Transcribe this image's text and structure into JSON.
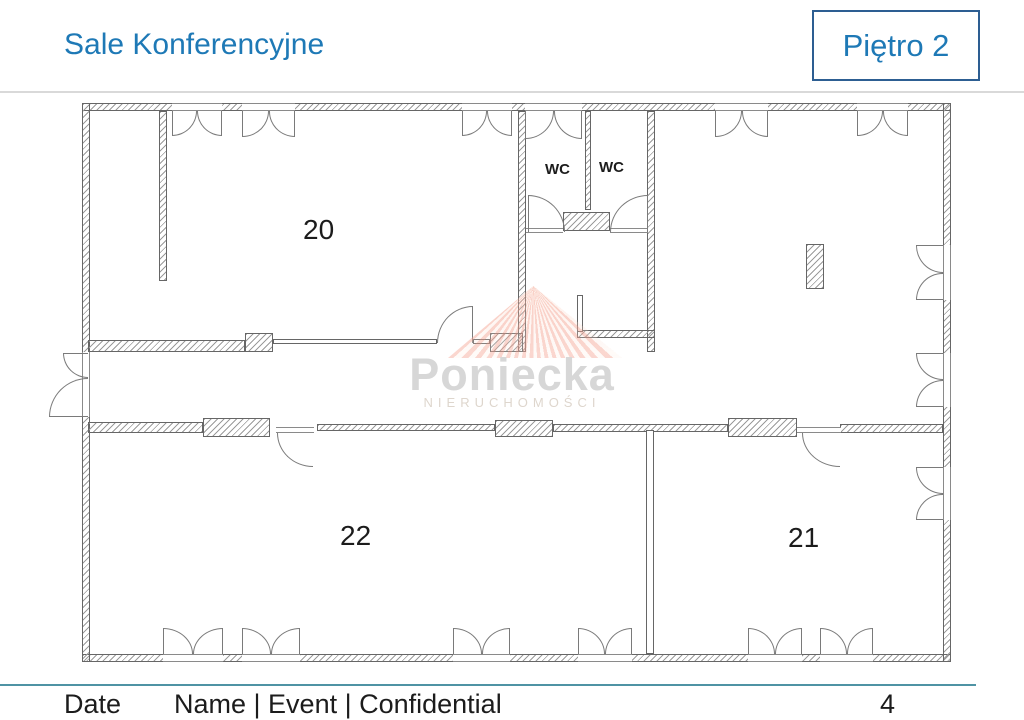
{
  "header": {
    "title": "Sale Konferencyjne",
    "floor_badge": "Piętro 2"
  },
  "plan": {
    "room20": "20",
    "room21": "21",
    "room22": "22",
    "wc_left": "WC",
    "wc_right": "WC"
  },
  "watermark": {
    "brand": "Poniecka",
    "subtitle": "NIERUCHOMOŚCI"
  },
  "footer": {
    "date_label": "Date",
    "meta": "Name | Event | Confidential",
    "page_number": "4"
  },
  "colors": {
    "accent": "#1e79b6",
    "badge-border": "#2d5e92",
    "footer-rule": "#4f93a4",
    "separator": "#d9d9d9"
  }
}
